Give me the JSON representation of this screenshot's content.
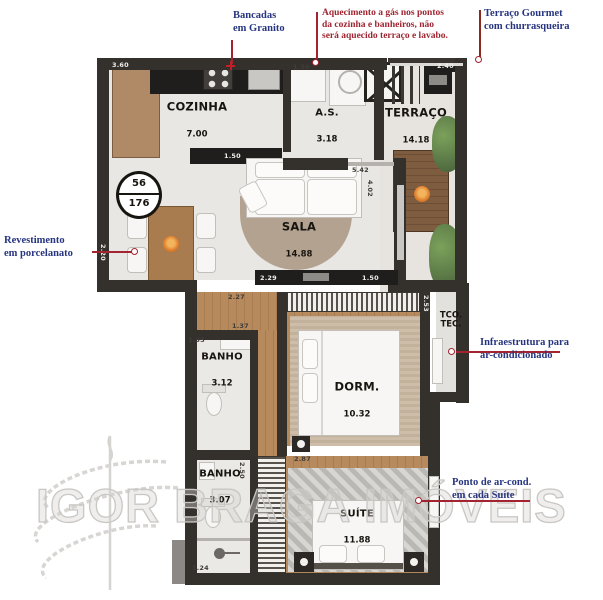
{
  "annotations": {
    "bancadas": "Bancadas\nem Granito",
    "aquecimento": "Aquecimento a gás nos pontos\nda cozinha e banheiros, não\nserá aquecido terraço e lavabo.",
    "terraco_gourmet": "Terraço Gourmet\ncom churrasqueira",
    "revestimento": "Revestimento\nem porcelanato",
    "infraestrutura": "Infraestrutura para\nar-condicionado",
    "ponto_ar": "Ponto de ar-cond.\nem cada Suíte"
  },
  "rooms": {
    "cozinha": {
      "name": "COZINHA",
      "area": "7.00"
    },
    "as": {
      "name": "A.S.",
      "area": "3.18"
    },
    "terraco": {
      "name": "TERRAÇO",
      "area": "14.18"
    },
    "sala": {
      "name": "SALA",
      "area": "14.88"
    },
    "banho1": {
      "name": "BANHO",
      "area": "3.12"
    },
    "dorm": {
      "name": "DORM.",
      "area": "10.32"
    },
    "banho2": {
      "name": "BANHO",
      "area": "3.07"
    },
    "suite": {
      "name": "SUÍTE",
      "area": "11.88"
    },
    "tco": {
      "name": "TCO.\nTEC."
    }
  },
  "unit_badge": {
    "top": "56",
    "bottom": "176"
  },
  "dims": {
    "a": "3.60",
    "b": "1.50",
    "c": "2.40",
    "d": "1.50",
    "e": "5.42",
    "f": "4.02",
    "g": "2.20",
    "h": "2.29",
    "i": "1.50",
    "j": "2.27",
    "k": "1.37",
    "l": "1.35",
    "m": "2.53",
    "n": "2.50",
    "o": "2.87",
    "p": "1.24"
  },
  "watermark": "IGOR BRAGA IMÓVEIS",
  "colors": {
    "annotation_blue": "#27357f",
    "annotation_red": "#9e2430",
    "leader_red": "#a32430",
    "wall": "#34302c",
    "wood": "#a87c50",
    "watermark_gray": "#c9c7c4"
  }
}
